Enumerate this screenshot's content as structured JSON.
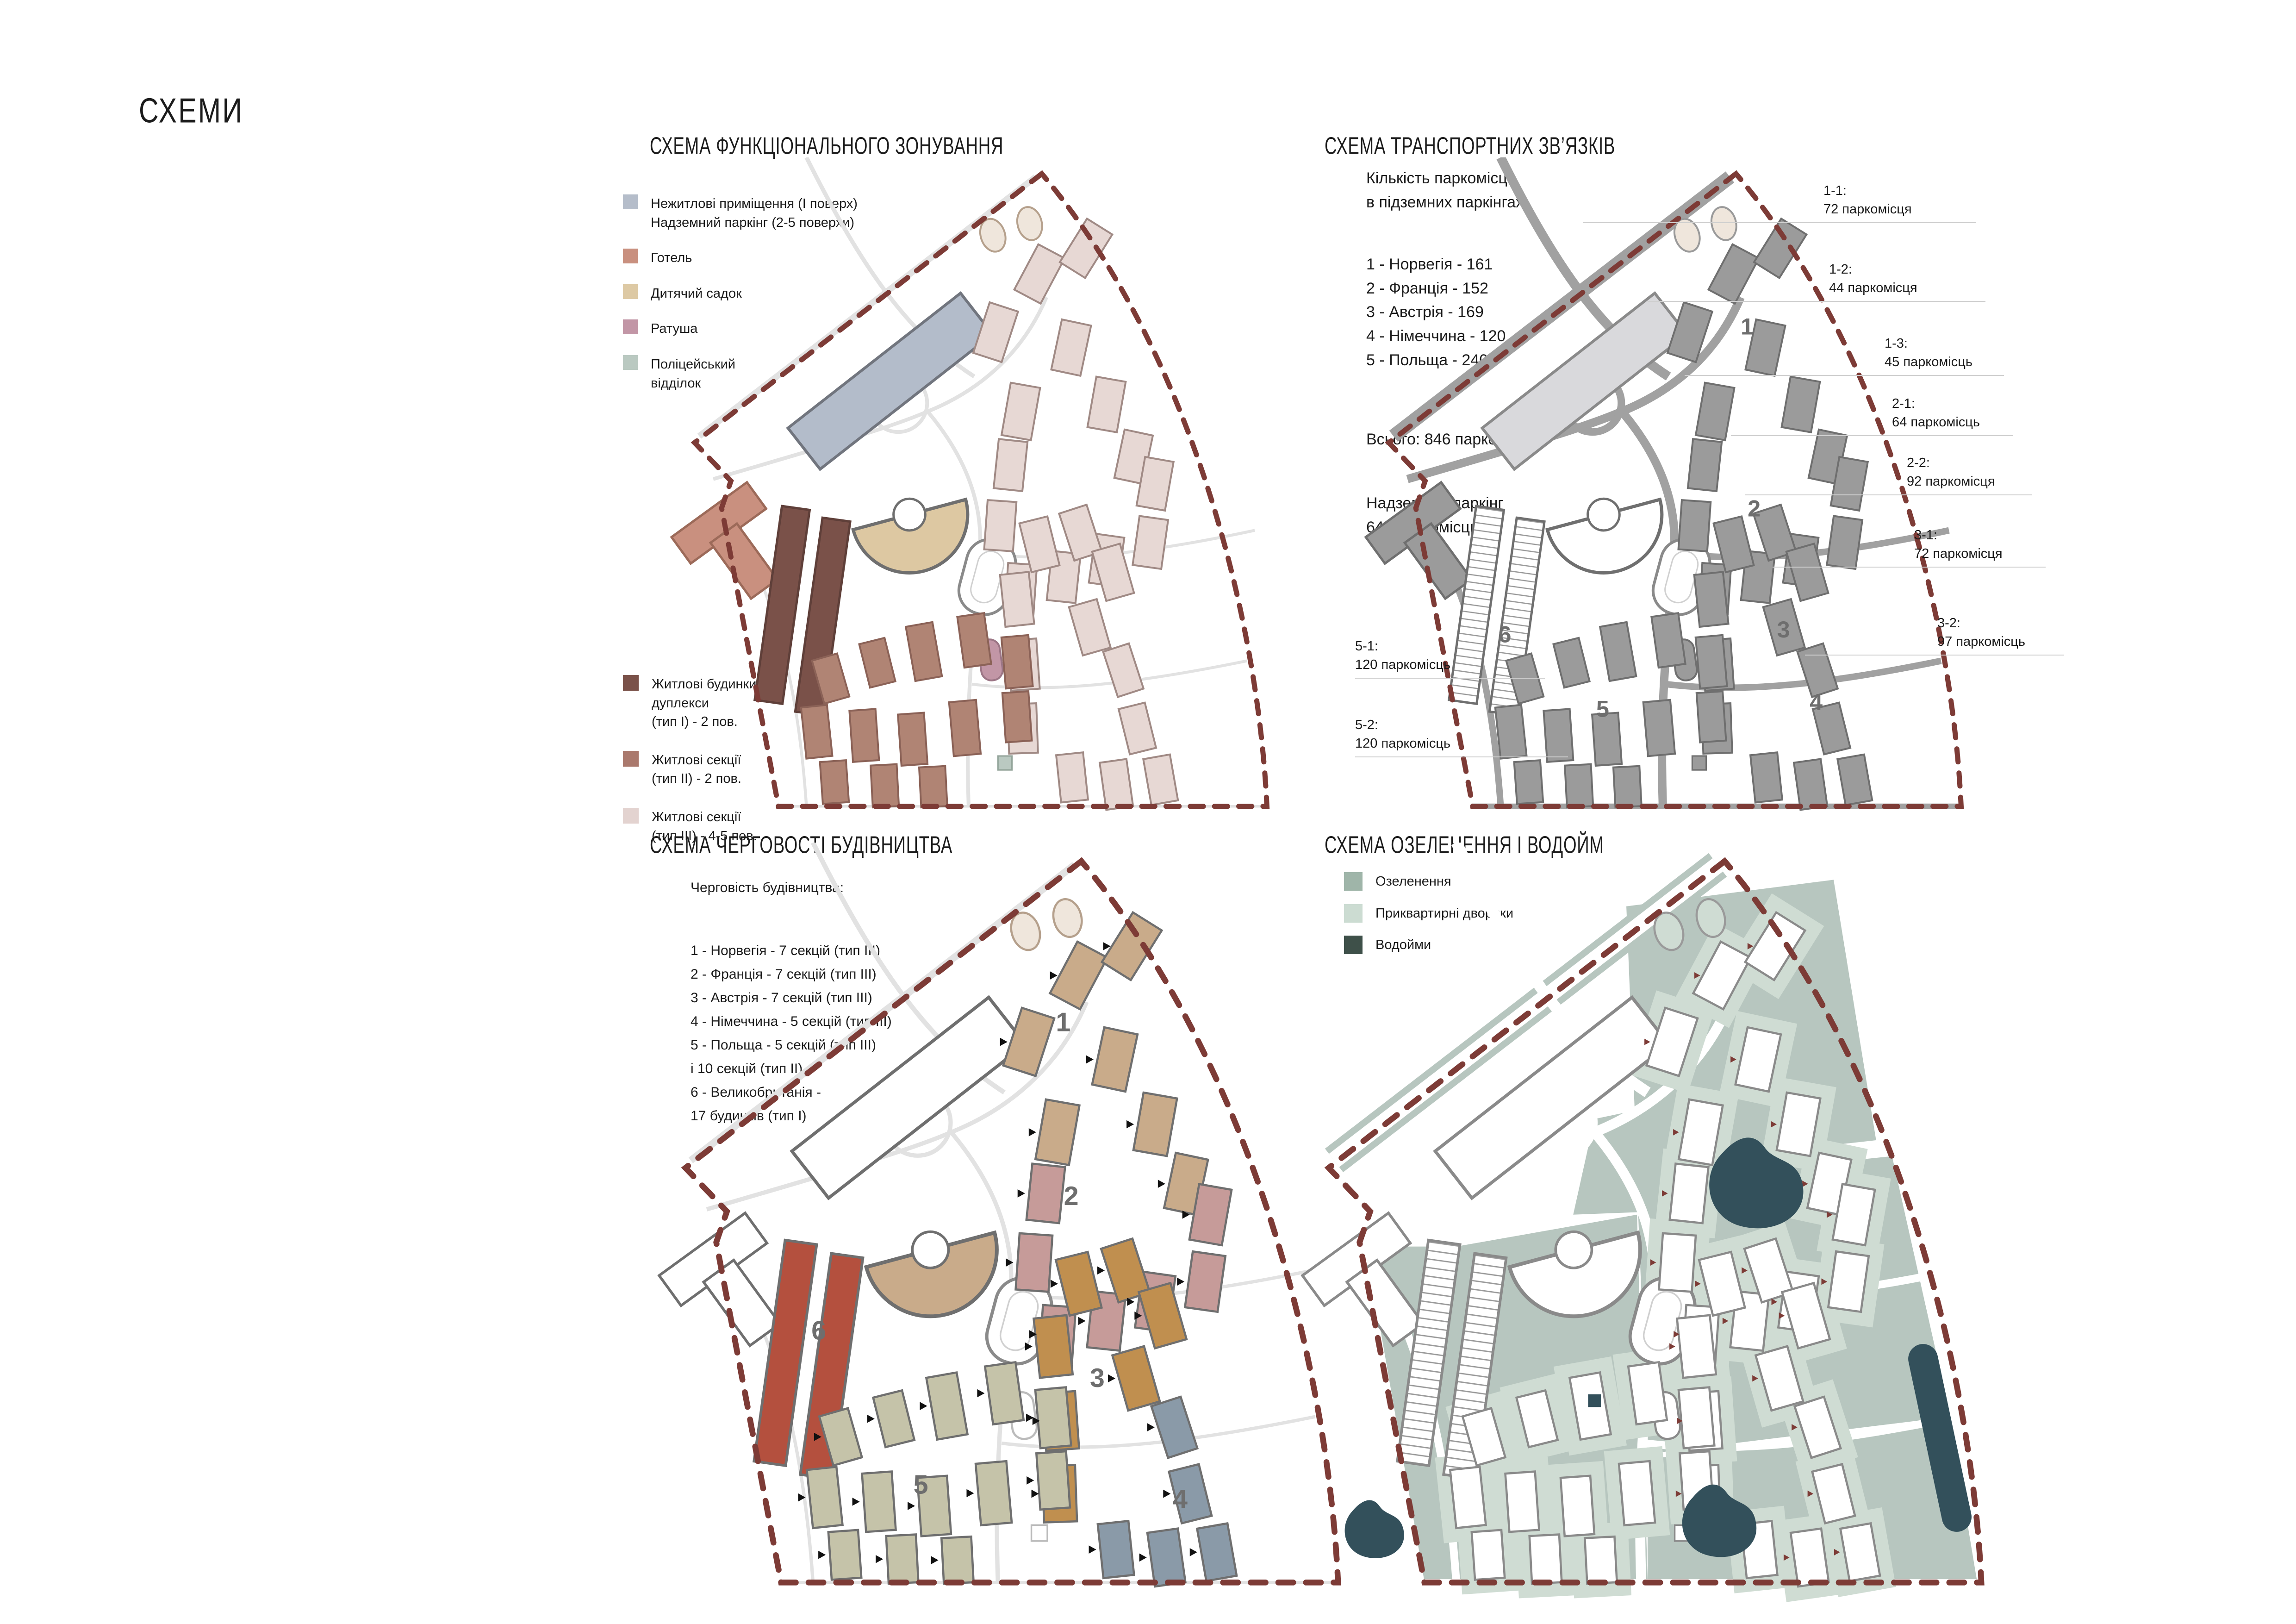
{
  "page": {
    "title": "СХЕМИ"
  },
  "colors": {
    "boundary": "#7d3b36",
    "leader_line": "#cfcfcf",
    "zone_number": "#6e6e6e",
    "map": {
      "s1": {
        "type3": "#e7d8d4",
        "type2": "#b08474",
        "type1": "#7a5149",
        "parking": "#b3bcca",
        "hotel": "#c9907f",
        "kindergarten": "#ddc8a2",
        "townhall": "#c296a6",
        "police": "#bac9c1",
        "road": "#e2e2e2"
      },
      "s2": {
        "building": "#9b9b9b",
        "building_stroke": "#6f6f6f",
        "parking": "#d9d9dc",
        "road": "#a1a1a1"
      },
      "s3": {
        "z1": "#c9ab8a",
        "z2": "#c69b99",
        "z3": "#c08f4f",
        "z4": "#8a9aa8",
        "z5": "#c5c3a9",
        "z6": "#b4503e",
        "kindergarten": "#c9ab8a",
        "road": "#e2e2e2"
      },
      "s4": {
        "green": "#b7c6bf",
        "courtyard": "#cfdcd3",
        "water": "#33505b",
        "marker": "#7d3b36"
      }
    }
  },
  "scheme1": {
    "title": "СХЕМА ФУНКЦІОНАЛЬНОГО ЗОНУВАННЯ",
    "legend_top": [
      {
        "color": "#b5bdca",
        "lines": [
          "Нежитлові приміщення (І поверх)",
          "Надземний паркінг (2-5 поверхи)"
        ]
      },
      {
        "color": "#c9907f",
        "lines": [
          "Готель"
        ]
      },
      {
        "color": "#ddc9a4",
        "lines": [
          "Дитячий садок"
        ]
      },
      {
        "color": "#c296a6",
        "lines": [
          "Ратуша"
        ]
      },
      {
        "color": "#bac9c1",
        "lines": [
          "Поліцейський",
          "відділок"
        ]
      }
    ],
    "legend_bottom": [
      {
        "color": "#7a5149",
        "lines": [
          "Житлові будинки,",
          "дуплекси",
          "(тип І) - 2 пов."
        ]
      },
      {
        "color": "#aa796d",
        "lines": [
          "Житлові секції",
          "(тип ІІ) - 2 пов."
        ]
      },
      {
        "color": "#e3d3d0",
        "lines": [
          "Житлові секції",
          "(тип ІІІ) - 4-5 пов."
        ]
      }
    ]
  },
  "scheme2": {
    "title": "СХЕМА ТРАНСПОРТНИХ ЗВ’ЯЗКІВ",
    "intro": [
      "Кількість паркомісць",
      "в підземних паркінгах:"
    ],
    "list": [
      "1 - Норвегія - 161",
      "2 - Франція - 152",
      "3 - Австрія - 169",
      "4 - Німеччина - 120",
      "5 - Польща - 240"
    ],
    "total": "Всього: 846 паркомісця",
    "overground": [
      "Надземний паркінг",
      "640 паркомісць"
    ],
    "zone_numbers": [
      "1",
      "2",
      "3",
      "4",
      "5",
      "6"
    ],
    "callouts": [
      {
        "id": "1-1:",
        "value": "72 паркомісця"
      },
      {
        "id": "1-2:",
        "value": "44 паркомісця"
      },
      {
        "id": "1-3:",
        "value": "45 паркомісць"
      },
      {
        "id": "2-1:",
        "value": "64 паркомісць"
      },
      {
        "id": "2-2:",
        "value": "92 паркомісця"
      },
      {
        "id": "3-1:",
        "value": "72 паркомісця"
      },
      {
        "id": "3-2:",
        "value": "97 паркомісць"
      },
      {
        "id": "5-1:",
        "value": "120 паркомісць"
      },
      {
        "id": "5-2:",
        "value": "120 паркомісць"
      }
    ]
  },
  "scheme3": {
    "title": "СХЕМА ЧЕРГОВОСТІ БУДІВНИЦТВА",
    "intro": "Черговість будівництва:",
    "list": [
      "1 - Норвегія - 7 секцій (тип ІІІ)",
      "2 - Франція - 7 секцій (тип ІІІ)",
      "3 - Австрія - 7 секцій (тип ІІІ)",
      "4 - Німеччина - 5 секцій (тип ІІІ)",
      "5 - Польща - 5 секцій (тип ІІІ)",
      "і 10 секцій (тип ІІ)",
      "6 - Великобританія -",
      "17 будинків (тип І)"
    ],
    "zone_numbers": [
      "1",
      "2",
      "3",
      "4",
      "5",
      "6"
    ]
  },
  "scheme4": {
    "title": "СХЕМА ОЗЕЛЕНЕННЯ І ВОДОЙМ",
    "legend": [
      {
        "color": "#9fb5a9",
        "label": "Озеленення"
      },
      {
        "color": "#ccdcd2",
        "label": "Приквартирні дворики"
      },
      {
        "color": "#3e5049",
        "label": "Водойми"
      }
    ]
  }
}
